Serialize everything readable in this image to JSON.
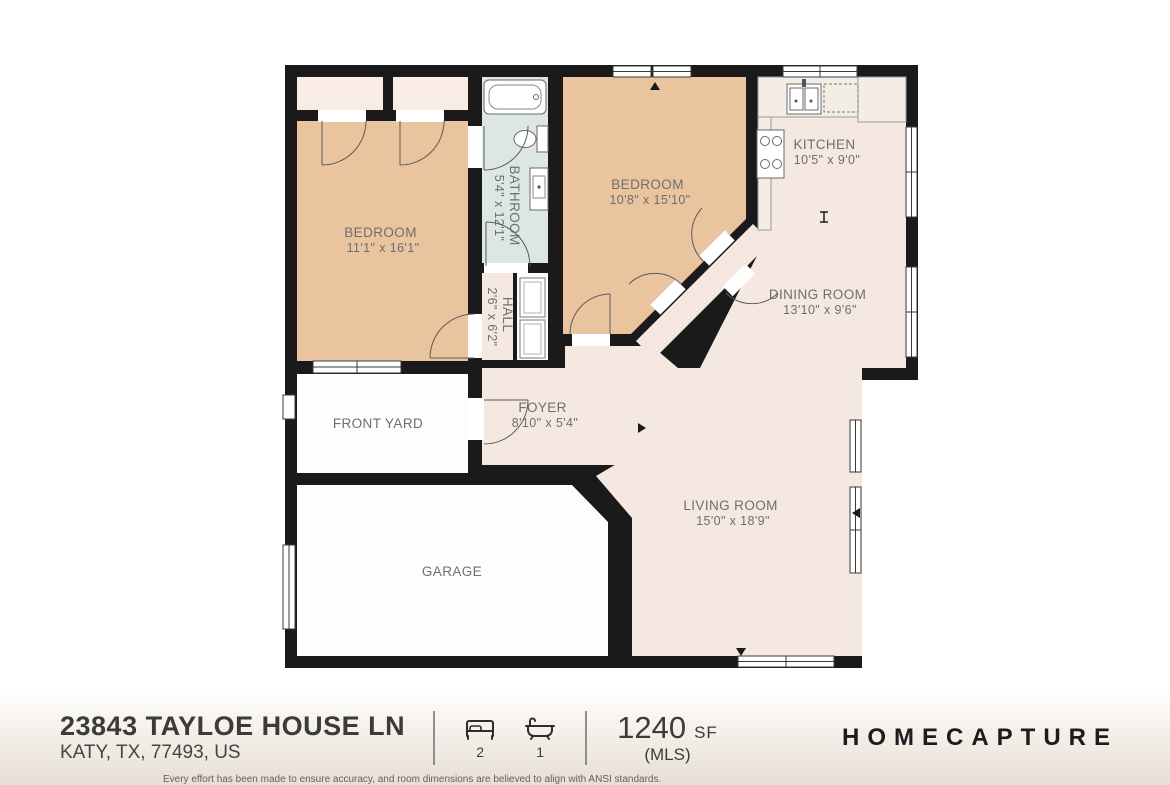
{
  "plan": {
    "rooms": {
      "bedroom1": {
        "label": "BEDROOM",
        "dims": "11'1\" x 16'1\""
      },
      "bedroom2": {
        "label": "BEDROOM",
        "dims": "10'8\" x 15'10\""
      },
      "bathroom": {
        "label": "BATHROOM",
        "dims": "5'4\" x 12'1\""
      },
      "hall": {
        "label": "HALL",
        "dims": "2'6\" x 6'2\""
      },
      "kitchen": {
        "label": "KITCHEN",
        "dims": "10'5\" x 9'0\""
      },
      "dining_room": {
        "label": "DINING ROOM",
        "dims": "13'10\" x 9'6\""
      },
      "foyer": {
        "label": "FOYER",
        "dims": "8'10\" x 5'4\""
      },
      "living_room": {
        "label": "LIVING ROOM",
        "dims": "15'0\" x 18'9\""
      },
      "front_yard": {
        "label": "FRONT YARD"
      },
      "garage": {
        "label": "GARAGE"
      }
    },
    "colors": {
      "bedroom_fill": "#e9c49e",
      "bathroom_fill": "#dde7e1",
      "living_fill": "#f5e8e1",
      "closet_fill": "#f8ece4",
      "garage_fill": "#fdfdfd",
      "wall": "#1a1a1a",
      "label_text": "#6e6e6e"
    }
  },
  "footer": {
    "address_line1": "23843 TAYLOE HOUSE LN",
    "address_line2": "KATY, TX, 77493, US",
    "beds_count": "2",
    "baths_count": "1",
    "area_value": "1240",
    "area_unit": "SF",
    "area_source": "(MLS)",
    "brand": "HOMECAPTURE",
    "disclaimer": "Every effort has been made to ensure accuracy, and room dimensions are believed to align with ANSI standards."
  }
}
